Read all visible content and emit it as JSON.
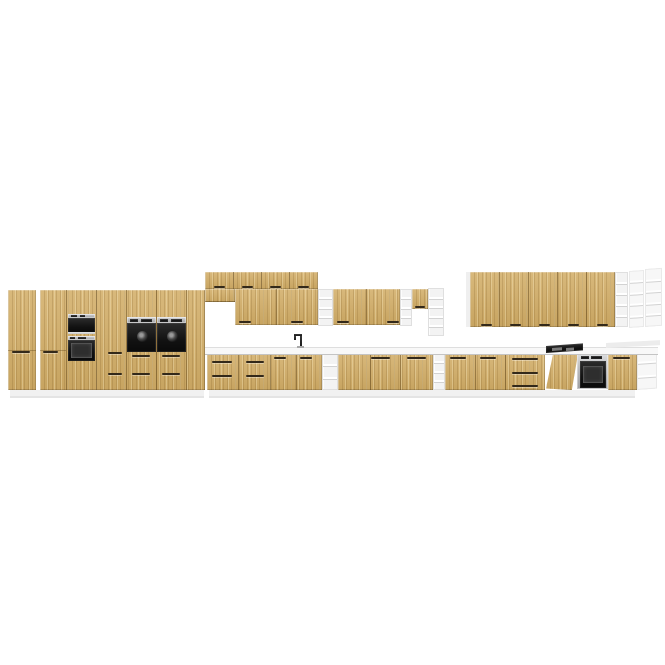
{
  "scene": {
    "canvas": {
      "width": 665,
      "height": 665
    },
    "palette": {
      "background": "#ffffff",
      "wood_front": "#d2ad66",
      "wood_seam": "#563c12",
      "handle": "#33291a",
      "white_panel": "#f1f1f1",
      "floor_shadow": "#e4e4e4",
      "counter": "#f8f8f8",
      "steel": "#b9babc",
      "appliance_black": "#141414",
      "shelf_white": "#f3f3f3"
    },
    "elements": [
      {
        "name": "plinth-left",
        "type": "panel",
        "x": 10,
        "y": 390,
        "w": 194,
        "h": 6,
        "fill": "#f1f1f1"
      },
      {
        "name": "floor-shadow-left",
        "type": "panel",
        "x": 10,
        "y": 396,
        "w": 194,
        "h": 2,
        "fill": "#e4e4e4"
      },
      {
        "name": "plinth-base-row",
        "type": "panel",
        "x": 209,
        "y": 390,
        "w": 426,
        "h": 6,
        "fill": "#f1f1f1"
      },
      {
        "name": "floor-shadow-base-row",
        "type": "panel",
        "x": 209,
        "y": 396,
        "w": 426,
        "h": 2,
        "fill": "#e4e4e4"
      },
      {
        "name": "tall-cabinet-1",
        "type": "wood",
        "x": 8,
        "y": 290,
        "w": 28,
        "h": 100
      },
      {
        "name": "tall-cabinet-1-door-seam",
        "type": "seam-h",
        "x": 8,
        "y": 350,
        "w": 28,
        "h": 1
      },
      {
        "name": "tall-cabinet-1-handle",
        "type": "handle",
        "x": 12,
        "y": 351,
        "w": 18,
        "h": 2
      },
      {
        "name": "tall-cabinet-run",
        "type": "wood",
        "x": 40,
        "y": 290,
        "w": 165,
        "h": 100
      },
      {
        "name": "tall-run-seam-1",
        "type": "seam",
        "x": 66,
        "y": 290,
        "w": 1,
        "h": 100
      },
      {
        "name": "tall-run-seam-2",
        "type": "seam",
        "x": 96,
        "y": 290,
        "w": 1,
        "h": 100
      },
      {
        "name": "tall-run-seam-3",
        "type": "seam",
        "x": 126,
        "y": 290,
        "w": 1,
        "h": 100
      },
      {
        "name": "tall-run-seam-4",
        "type": "seam",
        "x": 156,
        "y": 290,
        "w": 1,
        "h": 100
      },
      {
        "name": "tall-run-seam-5",
        "type": "seam",
        "x": 186,
        "y": 290,
        "w": 1,
        "h": 100
      },
      {
        "name": "tall-cabinet-2-door-seam",
        "type": "seam-h",
        "x": 40,
        "y": 350,
        "w": 26,
        "h": 1
      },
      {
        "name": "tall-cabinet-2-handle",
        "type": "handle",
        "x": 43,
        "y": 351,
        "w": 15,
        "h": 2
      },
      {
        "name": "tall-cabinet-3-handle-upper",
        "type": "handle",
        "x": 108,
        "y": 352,
        "w": 14,
        "h": 2
      },
      {
        "name": "tall-cabinet-3-handle-lower",
        "type": "handle",
        "x": 108,
        "y": 373,
        "w": 14,
        "h": 2
      },
      {
        "name": "microwave-control-strip",
        "type": "steel",
        "x": 68,
        "y": 314,
        "w": 27,
        "h": 4
      },
      {
        "name": "microwave-button-1",
        "type": "black",
        "x": 71,
        "y": 315,
        "w": 6,
        "h": 2
      },
      {
        "name": "microwave-button-2",
        "type": "black",
        "x": 80,
        "y": 315,
        "w": 5,
        "h": 2
      },
      {
        "name": "microwave-door",
        "type": "black",
        "x": 68,
        "y": 318,
        "w": 27,
        "h": 15
      },
      {
        "name": "microwave-trim",
        "type": "steel",
        "x": 68,
        "y": 332,
        "w": 27,
        "h": 2
      },
      {
        "name": "oven-tower-control-strip",
        "type": "steel",
        "x": 68,
        "y": 336,
        "w": 27,
        "h": 4
      },
      {
        "name": "oven-tower-button-1",
        "type": "black",
        "x": 70,
        "y": 337,
        "w": 5,
        "h": 2
      },
      {
        "name": "oven-tower-button-2",
        "type": "black",
        "x": 78,
        "y": 337,
        "w": 8,
        "h": 2
      },
      {
        "name": "oven-tower-door",
        "type": "black",
        "x": 68,
        "y": 340,
        "w": 27,
        "h": 21
      },
      {
        "name": "oven-tower-window",
        "type": "win",
        "x": 71,
        "y": 343,
        "w": 21,
        "h": 15
      },
      {
        "name": "mid-oven-1-control-strip",
        "type": "steel",
        "x": 127,
        "y": 317,
        "w": 29,
        "h": 6
      },
      {
        "name": "mid-oven-1-display",
        "type": "black",
        "x": 130,
        "y": 319,
        "w": 8,
        "h": 3
      },
      {
        "name": "mid-oven-1-buttons",
        "type": "black",
        "x": 141,
        "y": 319,
        "w": 11,
        "h": 3
      },
      {
        "name": "mid-oven-1-door",
        "type": "black",
        "x": 127,
        "y": 323,
        "w": 29,
        "h": 29
      },
      {
        "name": "mid-oven-1-dial",
        "type": "dial",
        "x": 137,
        "y": 331,
        "w": 11,
        "h": 11
      },
      {
        "name": "mid-oven-2-control-strip",
        "type": "steel",
        "x": 157,
        "y": 317,
        "w": 29,
        "h": 6
      },
      {
        "name": "mid-oven-2-display",
        "type": "black",
        "x": 160,
        "y": 319,
        "w": 8,
        "h": 3
      },
      {
        "name": "mid-oven-2-buttons",
        "type": "black",
        "x": 171,
        "y": 319,
        "w": 11,
        "h": 3
      },
      {
        "name": "mid-oven-2-door",
        "type": "black",
        "x": 157,
        "y": 323,
        "w": 29,
        "h": 29
      },
      {
        "name": "mid-oven-2-dial",
        "type": "dial",
        "x": 167,
        "y": 331,
        "w": 11,
        "h": 11
      },
      {
        "name": "mid-oven-1-drawer-handle-upper",
        "type": "handle",
        "x": 132,
        "y": 355,
        "w": 18,
        "h": 2
      },
      {
        "name": "mid-oven-2-drawer-handle-upper",
        "type": "handle",
        "x": 162,
        "y": 355,
        "w": 18,
        "h": 2
      },
      {
        "name": "mid-oven-1-drawer-handle-lower",
        "type": "handle",
        "x": 132,
        "y": 373,
        "w": 18,
        "h": 2
      },
      {
        "name": "mid-oven-2-drawer-handle-lower",
        "type": "handle",
        "x": 162,
        "y": 373,
        "w": 18,
        "h": 2
      },
      {
        "name": "top-cupboard-row",
        "type": "wood",
        "x": 205,
        "y": 272,
        "w": 113,
        "h": 17
      },
      {
        "name": "top-row-seam-1",
        "type": "seam",
        "x": 233,
        "y": 272,
        "w": 1,
        "h": 17
      },
      {
        "name": "top-row-seam-2",
        "type": "seam",
        "x": 261,
        "y": 272,
        "w": 1,
        "h": 17
      },
      {
        "name": "top-row-seam-3",
        "type": "seam",
        "x": 289,
        "y": 272,
        "w": 1,
        "h": 17
      },
      {
        "name": "top-row-handle-1",
        "type": "handle",
        "x": 214,
        "y": 286,
        "w": 11,
        "h": 2
      },
      {
        "name": "top-row-handle-2",
        "type": "handle",
        "x": 242,
        "y": 286,
        "w": 11,
        "h": 2
      },
      {
        "name": "top-row-handle-3",
        "type": "handle",
        "x": 270,
        "y": 286,
        "w": 11,
        "h": 2
      },
      {
        "name": "top-row-handle-4",
        "type": "handle",
        "x": 298,
        "y": 286,
        "w": 11,
        "h": 2
      },
      {
        "name": "hood-cabinet",
        "type": "wood",
        "x": 205,
        "y": 289,
        "w": 30,
        "h": 13
      },
      {
        "name": "hood-cabinet-bottom",
        "type": "seam-h",
        "x": 205,
        "y": 301,
        "w": 30,
        "h": 1
      },
      {
        "name": "wall-cabinet-left",
        "type": "wood",
        "x": 235,
        "y": 289,
        "w": 83,
        "h": 36
      },
      {
        "name": "wall-cab-left-seam",
        "type": "seam",
        "x": 276,
        "y": 289,
        "w": 1,
        "h": 36
      },
      {
        "name": "wall-cab-left-handle-1",
        "type": "handle",
        "x": 239,
        "y": 321,
        "w": 12,
        "h": 2
      },
      {
        "name": "wall-cab-left-handle-2",
        "type": "handle",
        "x": 291,
        "y": 321,
        "w": 12,
        "h": 2
      },
      {
        "name": "wall-open-shelf-1",
        "type": "shelf",
        "x": 318,
        "y": 289,
        "w": 15,
        "h": 37,
        "cells": 4
      },
      {
        "name": "wall-cabinet-right",
        "type": "wood",
        "x": 333,
        "y": 289,
        "w": 67,
        "h": 36
      },
      {
        "name": "wall-cab-right-seam",
        "type": "seam",
        "x": 366,
        "y": 289,
        "w": 1,
        "h": 36
      },
      {
        "name": "wall-cab-right-handle-1",
        "type": "handle",
        "x": 337,
        "y": 321,
        "w": 12,
        "h": 2
      },
      {
        "name": "wall-cab-right-handle-2",
        "type": "handle",
        "x": 387,
        "y": 321,
        "w": 12,
        "h": 2
      },
      {
        "name": "wall-open-shelf-2",
        "type": "shelf",
        "x": 400,
        "y": 289,
        "w": 12,
        "h": 37,
        "cells": 4
      },
      {
        "name": "small-wall-cabinet",
        "type": "wood",
        "x": 412,
        "y": 289,
        "w": 16,
        "h": 20
      },
      {
        "name": "small-wall-cabinet-handle",
        "type": "handle",
        "x": 415,
        "y": 306,
        "w": 10,
        "h": 2
      },
      {
        "name": "wall-open-shelf-3",
        "type": "shelf",
        "x": 428,
        "y": 288,
        "w": 16,
        "h": 48,
        "cells": 5
      },
      {
        "name": "right-wall-row-end-panel",
        "type": "panel",
        "x": 466,
        "y": 272,
        "w": 4,
        "h": 55,
        "fill": "#efefef"
      },
      {
        "name": "right-wall-cabinet-row",
        "type": "wood",
        "x": 470,
        "y": 272,
        "w": 145,
        "h": 55
      },
      {
        "name": "right-row-seam-1",
        "type": "seam",
        "x": 499,
        "y": 272,
        "w": 1,
        "h": 55
      },
      {
        "name": "right-row-seam-2",
        "type": "seam",
        "x": 528,
        "y": 272,
        "w": 1,
        "h": 55
      },
      {
        "name": "right-row-seam-3",
        "type": "seam",
        "x": 557,
        "y": 272,
        "w": 1,
        "h": 55
      },
      {
        "name": "right-row-seam-4",
        "type": "seam",
        "x": 586,
        "y": 272,
        "w": 1,
        "h": 55
      },
      {
        "name": "right-row-handle-1",
        "type": "handle",
        "x": 481,
        "y": 324,
        "w": 11,
        "h": 2
      },
      {
        "name": "right-row-handle-2",
        "type": "handle",
        "x": 510,
        "y": 324,
        "w": 11,
        "h": 2
      },
      {
        "name": "right-row-handle-3",
        "type": "handle",
        "x": 539,
        "y": 324,
        "w": 11,
        "h": 2
      },
      {
        "name": "right-row-handle-4",
        "type": "handle",
        "x": 568,
        "y": 324,
        "w": 11,
        "h": 2
      },
      {
        "name": "right-row-handle-5",
        "type": "handle",
        "x": 597,
        "y": 324,
        "w": 11,
        "h": 2
      },
      {
        "name": "right-wall-open-shelf",
        "type": "shelf",
        "x": 615,
        "y": 272,
        "w": 13,
        "h": 55,
        "cells": 5
      },
      {
        "name": "right-wall-shelf-perspective-1",
        "type": "shelf",
        "x": 629,
        "y": 271,
        "w": 15,
        "h": 57,
        "cells": 5,
        "skew": -4,
        "light": true
      },
      {
        "name": "right-wall-shelf-perspective-2",
        "type": "shelf",
        "x": 645,
        "y": 269,
        "w": 17,
        "h": 58,
        "cells": 5,
        "skew": -4,
        "light": true
      },
      {
        "name": "base-run-sink-section",
        "type": "wood",
        "x": 207,
        "y": 353,
        "w": 115,
        "h": 37
      },
      {
        "name": "base-seam-1",
        "type": "seam",
        "x": 238,
        "y": 353,
        "w": 1,
        "h": 37
      },
      {
        "name": "base-seam-2",
        "type": "seam",
        "x": 270,
        "y": 353,
        "w": 1,
        "h": 37
      },
      {
        "name": "base-seam-3",
        "type": "seam",
        "x": 296,
        "y": 353,
        "w": 1,
        "h": 37
      },
      {
        "name": "drawer-unit-1-handle-top",
        "type": "handle",
        "x": 212,
        "y": 361,
        "w": 20,
        "h": 2
      },
      {
        "name": "drawer-unit-1-handle-bottom",
        "type": "handle",
        "x": 212,
        "y": 375,
        "w": 20,
        "h": 2
      },
      {
        "name": "drawer-unit-2-handle-top",
        "type": "handle",
        "x": 246,
        "y": 361,
        "w": 18,
        "h": 2
      },
      {
        "name": "drawer-unit-2-handle-bottom",
        "type": "handle",
        "x": 246,
        "y": 375,
        "w": 18,
        "h": 2
      },
      {
        "name": "sink-cabinet-handle-left",
        "type": "handle",
        "x": 274,
        "y": 357,
        "w": 12,
        "h": 2
      },
      {
        "name": "sink-cabinet-handle-right",
        "type": "handle",
        "x": 300,
        "y": 357,
        "w": 12,
        "h": 2
      },
      {
        "name": "base-open-shelf-1",
        "type": "shelf",
        "x": 322,
        "y": 353,
        "w": 16,
        "h": 37,
        "cells": 3
      },
      {
        "name": "base-run-mid",
        "type": "wood",
        "x": 338,
        "y": 353,
        "w": 95,
        "h": 37
      },
      {
        "name": "base-mid-seam-1",
        "type": "seam",
        "x": 370,
        "y": 353,
        "w": 1,
        "h": 37
      },
      {
        "name": "base-mid-seam-2",
        "type": "seam",
        "x": 400,
        "y": 353,
        "w": 1,
        "h": 37
      },
      {
        "name": "base-mid-handle-1",
        "type": "handle",
        "x": 371,
        "y": 357,
        "w": 19,
        "h": 2
      },
      {
        "name": "base-mid-handle-2",
        "type": "handle",
        "x": 407,
        "y": 357,
        "w": 19,
        "h": 2
      },
      {
        "name": "base-open-shelf-2",
        "type": "shelf",
        "x": 433,
        "y": 353,
        "w": 12,
        "h": 37,
        "cells": 4
      },
      {
        "name": "base-run-right",
        "type": "wood",
        "x": 445,
        "y": 353,
        "w": 100,
        "h": 37
      },
      {
        "name": "base-right-seam-1",
        "type": "seam",
        "x": 475,
        "y": 353,
        "w": 1,
        "h": 37
      },
      {
        "name": "base-right-seam-2",
        "type": "seam",
        "x": 505,
        "y": 353,
        "w": 1,
        "h": 37
      },
      {
        "name": "base-right-handle-1",
        "type": "handle",
        "x": 450,
        "y": 357,
        "w": 16,
        "h": 2
      },
      {
        "name": "base-right-handle-2",
        "type": "handle",
        "x": 480,
        "y": 357,
        "w": 16,
        "h": 2
      },
      {
        "name": "drawer-stack-handle-1",
        "type": "handle",
        "x": 512,
        "y": 358,
        "w": 26,
        "h": 2
      },
      {
        "name": "drawer-stack-handle-2",
        "type": "handle",
        "x": 512,
        "y": 372,
        "w": 26,
        "h": 2
      },
      {
        "name": "drawer-stack-handle-3",
        "type": "handle",
        "x": 512,
        "y": 385,
        "w": 26,
        "h": 2
      },
      {
        "name": "dishwasher-open-door",
        "type": "wood",
        "x": 546,
        "y": 354,
        "w": 34,
        "h": 36,
        "clip": "polygon(20% 3%, 94% 0%, 76% 100%, 0% 96%)"
      },
      {
        "name": "built-in-oven-frame",
        "type": "steel",
        "x": 577,
        "y": 354,
        "w": 31,
        "h": 35
      },
      {
        "name": "built-in-oven-display",
        "type": "black",
        "x": 581,
        "y": 356,
        "w": 8,
        "h": 3
      },
      {
        "name": "built-in-oven-buttons",
        "type": "black",
        "x": 591,
        "y": 356,
        "w": 11,
        "h": 3
      },
      {
        "name": "built-in-oven-door",
        "type": "black",
        "x": 580,
        "y": 361,
        "w": 26,
        "h": 27
      },
      {
        "name": "built-in-oven-window",
        "type": "win",
        "x": 583,
        "y": 366,
        "w": 20,
        "h": 17
      },
      {
        "name": "base-cabinet-far-right",
        "type": "wood",
        "x": 608,
        "y": 353,
        "w": 29,
        "h": 37
      },
      {
        "name": "base-far-right-handle",
        "type": "handle",
        "x": 613,
        "y": 357,
        "w": 17,
        "h": 2
      },
      {
        "name": "base-end-shelf-perspective",
        "type": "shelf",
        "x": 637,
        "y": 350,
        "w": 20,
        "h": 40,
        "cells": 3,
        "skew": -4,
        "light": true
      },
      {
        "name": "countertop",
        "type": "counter",
        "x": 205,
        "y": 347,
        "w": 453,
        "h": 6
      },
      {
        "name": "countertop-end-surface",
        "type": "panel",
        "x": 606,
        "y": 343,
        "w": 54,
        "h": 5,
        "fill": "#ececec",
        "skew": -3
      },
      {
        "name": "cooktop",
        "type": "black",
        "x": 546,
        "y": 346,
        "w": 37,
        "h": 7,
        "skew": -4
      },
      {
        "name": "cooktop-burner-1",
        "type": "panel",
        "x": 552,
        "y": 348,
        "w": 10,
        "h": 3,
        "fill": "#7b7b7b",
        "skew": -4
      },
      {
        "name": "cooktop-burner-2",
        "type": "panel",
        "x": 566,
        "y": 348,
        "w": 8,
        "h": 3,
        "fill": "#7b7b7b",
        "skew": -4
      },
      {
        "name": "faucet-stem",
        "type": "black",
        "x": 300,
        "y": 334,
        "w": 2,
        "h": 14
      },
      {
        "name": "faucet-spout-arm",
        "type": "black",
        "x": 294,
        "y": 334,
        "w": 8,
        "h": 2
      },
      {
        "name": "faucet-spout-tip",
        "type": "black",
        "x": 294,
        "y": 336,
        "w": 2,
        "h": 4
      },
      {
        "name": "faucet-base",
        "type": "panel",
        "x": 297,
        "y": 346,
        "w": 7,
        "h": 2,
        "fill": "#a8a8a8"
      }
    ]
  }
}
